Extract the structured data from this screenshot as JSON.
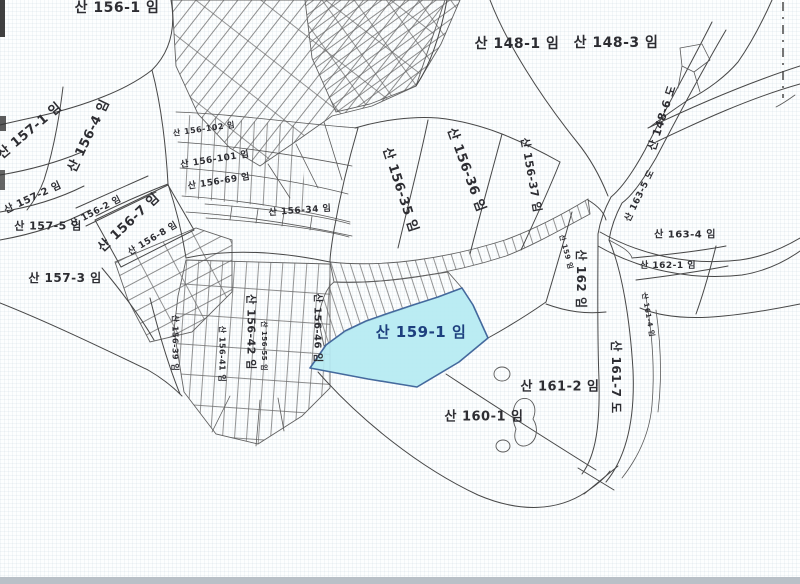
{
  "map": {
    "type": "cadastral-parcel-map",
    "ink": "#474747",
    "label_color": "#2d2d32",
    "edge_bar_color": "#b9c0c7",
    "highlight": {
      "parcel": "산 159-1 임",
      "fill": "#b5eaf2",
      "stroke": "#44699d",
      "label_color": "#1d3f7e"
    },
    "labels": [
      {
        "text": "산 156-1 임",
        "x": 117,
        "y": 8,
        "rot": 0,
        "size": 14
      },
      {
        "text": "산 148-1 임",
        "x": 517,
        "y": 44,
        "rot": 0,
        "size": 14
      },
      {
        "text": "산 148-3 임",
        "x": 616,
        "y": 43,
        "rot": 0,
        "size": 14
      },
      {
        "text": "산 148-6 도",
        "x": 662,
        "y": 118,
        "rot": -72,
        "size": 11
      },
      {
        "text": "산 157-1 임",
        "x": 30,
        "y": 131,
        "rot": -40,
        "size": 13
      },
      {
        "text": "산 156-4 임",
        "x": 89,
        "y": 136,
        "rot": -64,
        "size": 13
      },
      {
        "text": "산 157-2 임",
        "x": 33,
        "y": 198,
        "rot": -25,
        "size": 10
      },
      {
        "text": "산 157-5 임",
        "x": 48,
        "y": 226,
        "rot": 0,
        "size": 11
      },
      {
        "text": "산 156-2 임",
        "x": 96,
        "y": 212,
        "rot": -28,
        "size": 9
      },
      {
        "text": "산 156-7 임",
        "x": 129,
        "y": 223,
        "rot": -43,
        "size": 13
      },
      {
        "text": "산 156-8 임",
        "x": 153,
        "y": 239,
        "rot": -31,
        "size": 9
      },
      {
        "text": "산 157-3 임",
        "x": 65,
        "y": 278,
        "rot": 0,
        "size": 12
      },
      {
        "text": "산 156-102 임",
        "x": 204,
        "y": 129,
        "rot": -8,
        "size": 8
      },
      {
        "text": "산 156-101 임",
        "x": 215,
        "y": 160,
        "rot": -9,
        "size": 9
      },
      {
        "text": "산 156-69 임",
        "x": 219,
        "y": 182,
        "rot": -9,
        "size": 9
      },
      {
        "text": "산 156-34 임",
        "x": 300,
        "y": 211,
        "rot": -4,
        "size": 9
      },
      {
        "text": "산 156-35 임",
        "x": 400,
        "y": 190,
        "rot": 72,
        "size": 13
      },
      {
        "text": "산 156-36 임",
        "x": 466,
        "y": 170,
        "rot": 70,
        "size": 13
      },
      {
        "text": "산 156-37 임",
        "x": 531,
        "y": 175,
        "rot": 80,
        "size": 11
      },
      {
        "text": "산 162 임",
        "x": 581,
        "y": 279,
        "rot": 90,
        "size": 12
      },
      {
        "text": "산 163-5 도",
        "x": 640,
        "y": 196,
        "rot": -64,
        "size": 9
      },
      {
        "text": "산 163-4 임",
        "x": 685,
        "y": 235,
        "rot": 0,
        "size": 10
      },
      {
        "text": "산 162-1 임",
        "x": 668,
        "y": 266,
        "rot": 0,
        "size": 9
      },
      {
        "text": "산 161-7 도",
        "x": 616,
        "y": 377,
        "rot": 90,
        "size": 12
      },
      {
        "text": "산 159-1 임",
        "x": 421,
        "y": 332,
        "rot": 0,
        "size": 15,
        "color": "#1d3f7e"
      },
      {
        "text": "산 161-2 임",
        "x": 560,
        "y": 387,
        "rot": 0,
        "size": 13
      },
      {
        "text": "산 160-1 임",
        "x": 484,
        "y": 417,
        "rot": 0,
        "size": 13
      },
      {
        "text": "산 156-39 임",
        "x": 175,
        "y": 343,
        "rot": 90,
        "size": 8
      },
      {
        "text": "산 156-41 임",
        "x": 222,
        "y": 354,
        "rot": 90,
        "size": 8
      },
      {
        "text": "산 156-42 임",
        "x": 251,
        "y": 332,
        "rot": 90,
        "size": 11
      },
      {
        "text": "산 156-55 임",
        "x": 264,
        "y": 346,
        "rot": 90,
        "size": 7
      },
      {
        "text": "산 156-46 임",
        "x": 317,
        "y": 328,
        "rot": 90,
        "size": 10
      },
      {
        "text": "산 159 임",
        "x": 566,
        "y": 252,
        "rot": 75,
        "size": 7
      },
      {
        "text": "산 161-4 임",
        "x": 648,
        "y": 315,
        "rot": 80,
        "size": 7
      }
    ]
  }
}
